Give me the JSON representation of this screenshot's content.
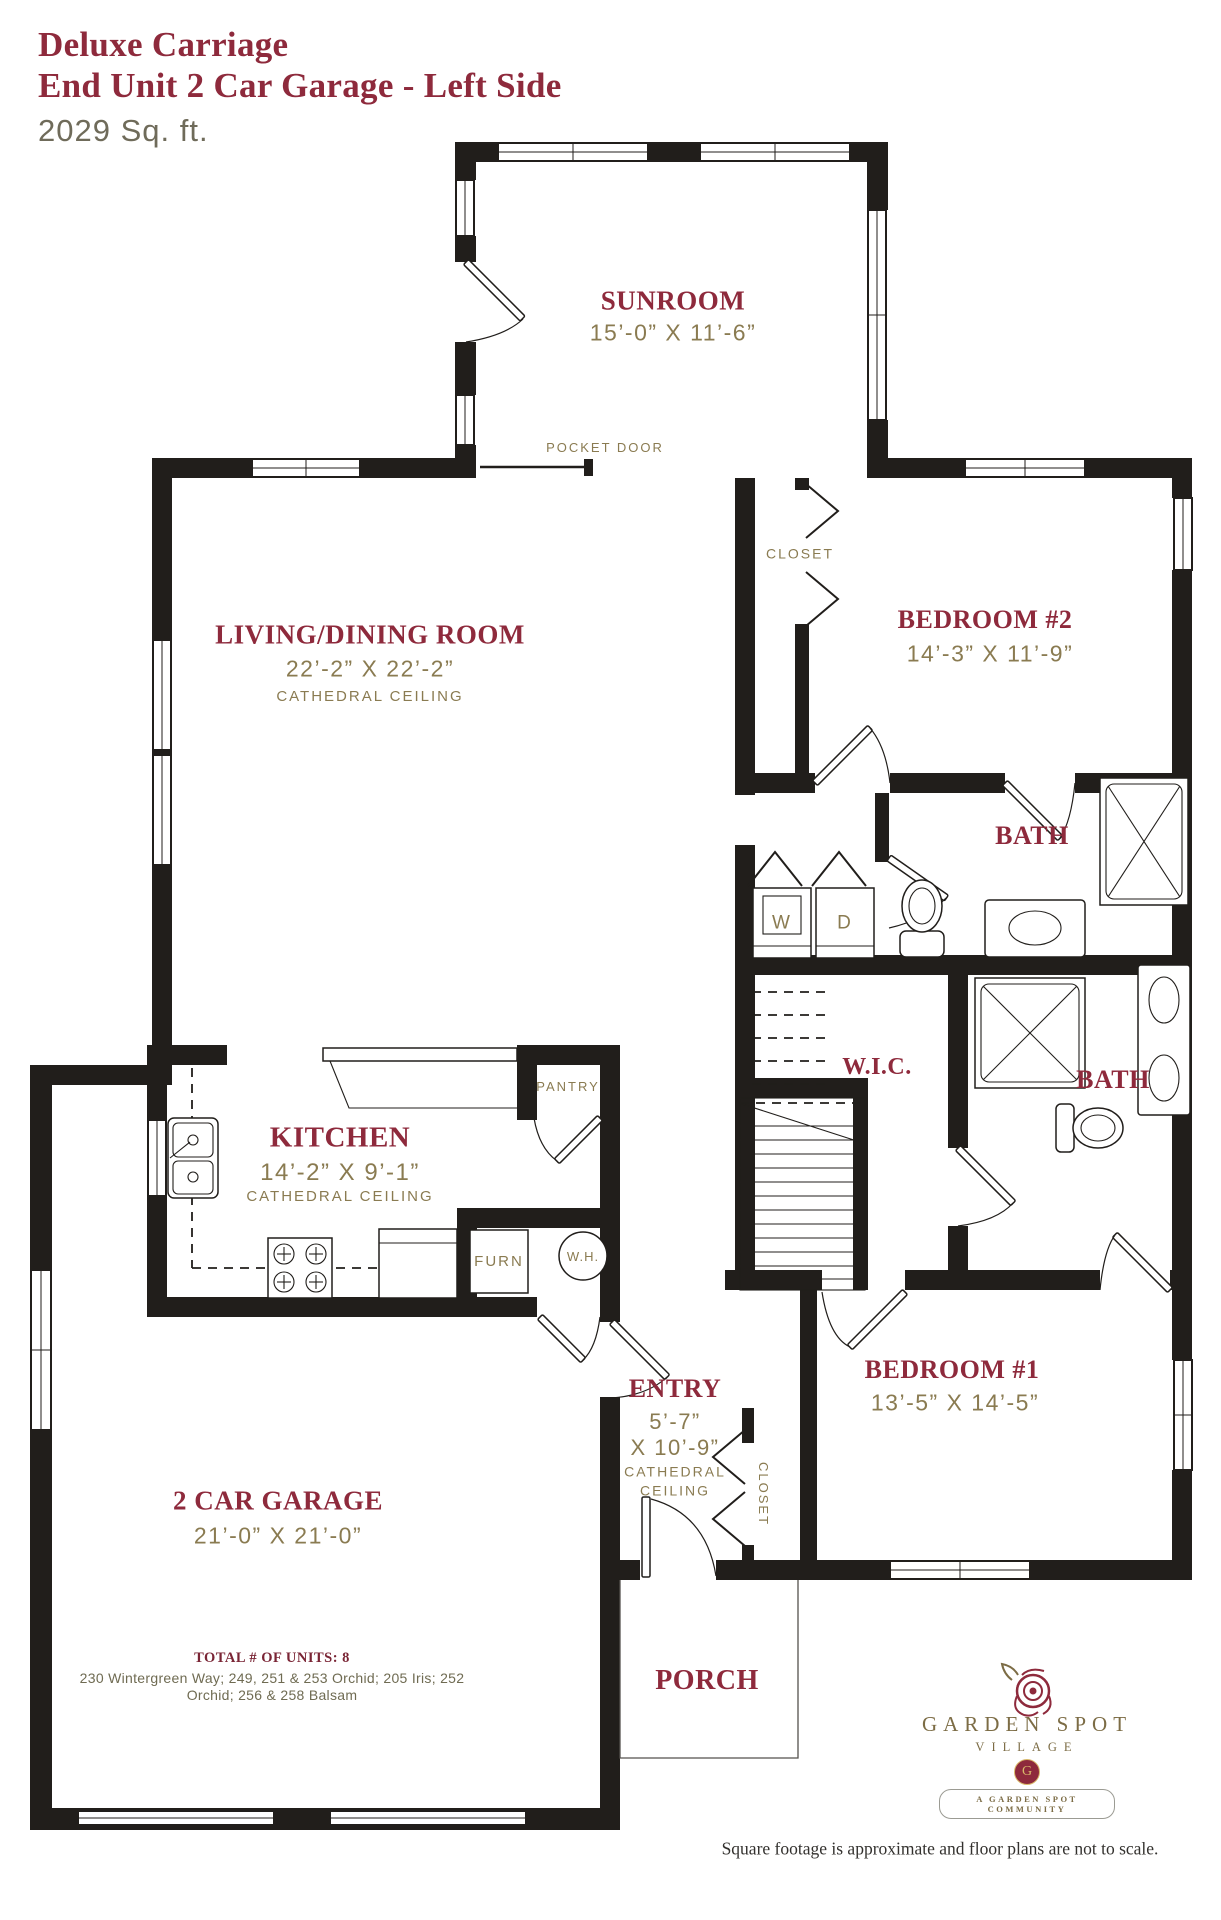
{
  "title": {
    "line1": "Deluxe Carriage",
    "line2": "End Unit 2 Car Garage - Left Side",
    "sqft": "2029 Sq. ft."
  },
  "rooms": {
    "sunroom": {
      "name": "SUNROOM",
      "dims": "15’-0” X 11’-6”"
    },
    "living": {
      "name": "LIVING/DINING ROOM",
      "dims": "22’-2” X 22’-2”",
      "note": "CATHEDRAL CEILING"
    },
    "bedroom2": {
      "name": "BEDROOM #2",
      "dims": "14’-3” X 11’-9”"
    },
    "bath1": {
      "name": "BATH"
    },
    "wic": {
      "name": "W.I.C."
    },
    "bath2": {
      "name": "BATH"
    },
    "kitchen": {
      "name": "KITCHEN",
      "dims": "14’-2” X 9’-1”",
      "note": "CATHEDRAL CEILING"
    },
    "entry": {
      "name": "ENTRY",
      "dims_line1": "5’-7”",
      "dims_line2": "X 10’-9”",
      "note_line1": "CATHEDRAL",
      "note_line2": "CEILING"
    },
    "bedroom1": {
      "name": "BEDROOM #1",
      "dims": "13’-5” X 14’-5”"
    },
    "garage": {
      "name": "2 CAR GARAGE",
      "dims": "21’-0” X 21’-0”"
    },
    "porch": {
      "name": "PORCH"
    }
  },
  "fixtures": {
    "pocket_door": "POCKET DOOR",
    "closet_bedroom2": "CLOSET",
    "closet_entry": "CLOSET",
    "pantry": "PANTRY",
    "furnace": "FURN",
    "water_heater": "W.H.",
    "washer": "W",
    "dryer": "D"
  },
  "footer": {
    "units_label": "TOTAL # OF UNITS: 8",
    "address_line1": "230 Wintergreen Way; 249, 251 & 253 Orchid; 205 Iris; 252",
    "address_line2": "Orchid; 256 & 258 Balsam",
    "disclaimer": "Square footage is approximate and floor plans are not to scale."
  },
  "logo": {
    "name": "GARDEN SPOT",
    "village": "VILLAGE",
    "monogram": "G",
    "tagline": "A GARDEN SPOT COMMUNITY"
  },
  "colors": {
    "maroon": "#8e2a3c",
    "olive": "#8a7b51",
    "muted": "#6f6b5a",
    "wall": "#211e1b",
    "gold": "#d9b96a"
  }
}
